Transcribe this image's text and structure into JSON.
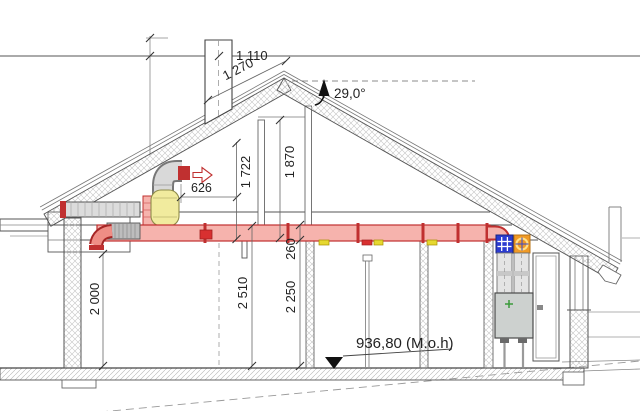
{
  "drawing": {
    "type": "architectural-cross-section",
    "description": "House section with balanced ventilation ducting and heat-recovery unit",
    "dimensions": {
      "d1110": "1 110",
      "d1270": "1 270",
      "roof_angle": "29,0°",
      "d626": "626",
      "d1722": "1 722",
      "d1870": "1 870",
      "d2000": "2 000",
      "d2510": "2 510",
      "d2250": "2 250",
      "d260": "260",
      "floor_level": "936,80 (M.o.h)"
    },
    "colors": {
      "duct_supply_fill": "#f6b3ad",
      "duct_supply_outline": "#c03030",
      "duct_gray_fill": "#d9d9d9",
      "silencer_yellow": "#f1eb9e",
      "valve_yellow": "#e6d830",
      "valve_red": "#d83030",
      "filter_supply_blue": "#2b3bd0",
      "filter_extract_orange": "#f09a26",
      "unit_plus_green": "#3a9a3a",
      "line": "#555555"
    },
    "icons": {
      "exhaust_arrow": "air-direction-arrow",
      "slope_arrow": "roof-pitch-arrow",
      "level_marker": "elevation-triangle"
    }
  }
}
